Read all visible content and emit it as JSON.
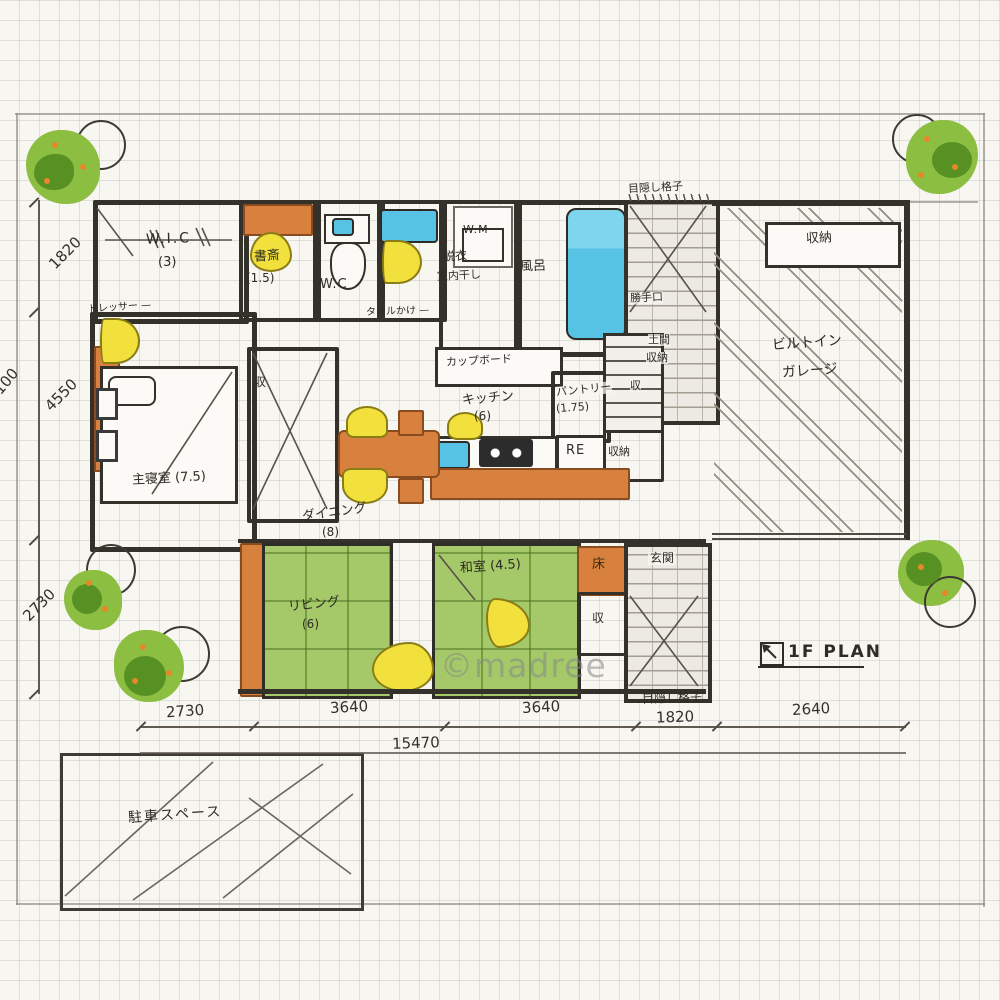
{
  "watermark": "©madree",
  "title": {
    "plan": "1F PLAN"
  },
  "rooms": {
    "wic": "W.I.C",
    "wic_size": "(3)",
    "study": "書斎",
    "study_size": "(1.5)",
    "wc": "W.C",
    "wm": "W.M",
    "datsui": "脱衣",
    "datsui2": "室内干し",
    "bath": "風呂",
    "towel": "タオルかけ —",
    "dresser": "ドレッサー —",
    "bedroom": "主寝室 (7.5)",
    "cupboard": "カップボード",
    "kitchen": "キッチン",
    "kitchen_size": "(6)",
    "pantry": "パントリー",
    "pantry_size": "(1.75)",
    "fridge": "RE",
    "dining": "ダイニング",
    "dining_size": "(8)",
    "living": "リビング",
    "living_size": "(6)",
    "washitsu": "和室 (4.5)",
    "toko": "床",
    "storage": "収",
    "storage_full": "収納",
    "genkan": "玄関",
    "katteguchi": "勝手口",
    "doma": "土間",
    "doma2": "収納",
    "garage": "ビルトイン",
    "garage2": "ガレージ",
    "garage_shelf": "収納",
    "parking": "駐車スペース",
    "fence": "目隠し格子"
  },
  "dims": {
    "bottom": [
      "2730",
      "3640",
      "3640",
      "1820",
      "2640"
    ],
    "total_w": "15470",
    "left": [
      "1820",
      "4550",
      "2730"
    ],
    "total_h": "9100"
  },
  "palette": {
    "tatami_green": "#a5c968",
    "wood_orange": "#d8813e",
    "water_blue": "#56c2e4",
    "chair_yellow": "#f2e03c",
    "tree_green": "#8cbe41",
    "wall_ink": "#34312b"
  }
}
